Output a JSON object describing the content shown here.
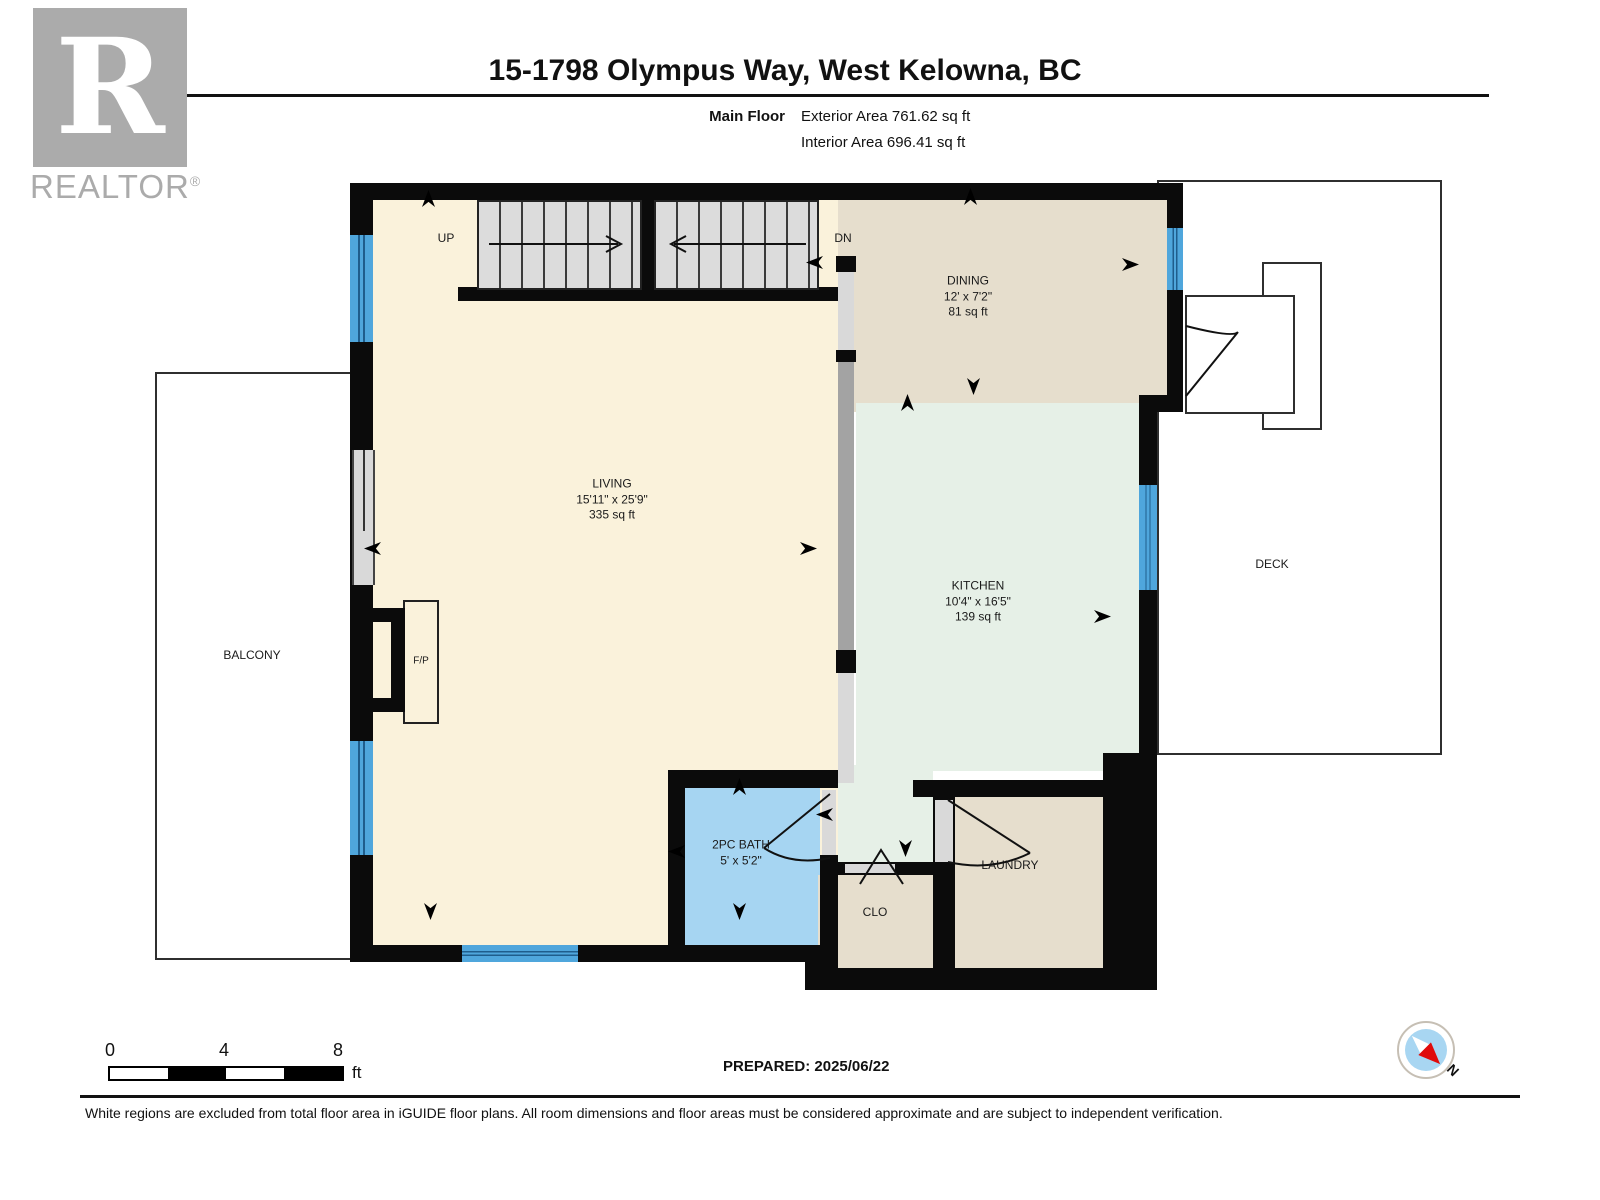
{
  "header": {
    "title": "15-1798 Olympus Way, West Kelowna, BC",
    "floor_label": "Main Floor",
    "exterior_area": "Exterior Area 761.62 sq ft",
    "interior_area": "Interior Area 696.41 sq ft"
  },
  "logo": {
    "letter": "R",
    "brand": "REALTOR",
    "reg": "®"
  },
  "rooms": {
    "living": {
      "name": "LIVING",
      "dims": "15'11\" x 25'9\"",
      "area": "335 sq ft"
    },
    "dining": {
      "name": "DINING",
      "dims": "12' x 7'2\"",
      "area": "81 sq ft"
    },
    "kitchen": {
      "name": "KITCHEN",
      "dims": "10'4\" x 16'5\"",
      "area": "139 sq ft"
    },
    "bath": {
      "name": "2PC BATH",
      "dims": "5' x 5'2\""
    },
    "closet": {
      "name": "CLO"
    },
    "laundry": {
      "name": "LAUNDRY"
    },
    "balcony": {
      "name": "BALCONY"
    },
    "deck": {
      "name": "DECK"
    }
  },
  "plan_labels": {
    "up": "UP",
    "down": "DN",
    "fireplace": "F/P"
  },
  "scale_bar": {
    "ticks": [
      "0",
      "4",
      "8"
    ],
    "unit": "ft"
  },
  "footer": {
    "prepared": "PREPARED: 2025/06/22",
    "disclaimer": "White regions are excluded from total floor area in iGUIDE floor plans. All room dimensions and floor areas must be considered approximate and are subject to independent verification.",
    "compass_label": "N"
  },
  "colors": {
    "wall": "#0b0b0b",
    "living_floor": "#faf2db",
    "dining_floor": "#e6decd",
    "kitchen_floor": "#e6f0e7",
    "bath_floor": "#a6d5f2",
    "window_blue": "#4fa6dc",
    "stair_gray": "#dcdcdc",
    "counter_gray": "#a3a3a3",
    "logo_gray": "#ababab",
    "compass_red": "#e00b0b",
    "compass_blue": "#a8d6f2"
  }
}
